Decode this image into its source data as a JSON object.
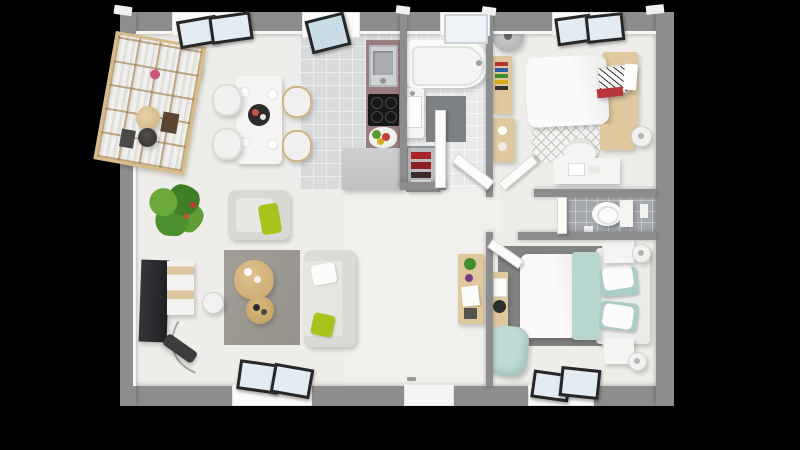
{
  "scene": {
    "title": "Top-down 3D render of a small apartment floor plan",
    "render_style": "photorealistic dollhouse view on black background",
    "background_color": "#000000",
    "rooms_count": 6
  },
  "palette": {
    "wall_gray": "#8d8d8d",
    "floor_ivory": "#f0eeeb",
    "kitchen_tile": "#d8dadc",
    "bath_tile": "#e7e9eb",
    "wc_tile": "#a4a8ac",
    "wood_light": "#e0c89e",
    "wood_mid": "#d2b582",
    "counter_mauve": "#997e81",
    "accent_lime": "#a6c41c",
    "accent_teal": "#b7d6d0",
    "accent_red": "#b8353a",
    "rug_taupe": "#9d9993",
    "rug_dark": "#828282",
    "tv_black": "#26282a",
    "glass_blue": "#e3ecf3",
    "frame_dark": "#262626",
    "plant_green": "#4e8f2e"
  },
  "rooms": [
    {
      "name": "living-dining-room",
      "furniture": [
        "bookshelf",
        "side-stool",
        "vase",
        "wall-lamp",
        "dining-table",
        "dining-chairs-x4",
        "place-settings",
        "serving-tray",
        "potted-plant",
        "tv-panel",
        "tv-stand",
        "arc-floor-lamp",
        "armchair",
        "lime-pillow",
        "taupe-rug",
        "round-coffee-table-large",
        "round-coffee-table-small",
        "sofa",
        "white-pillow",
        "lime-pillow"
      ]
    },
    {
      "name": "kitchen",
      "furniture": [
        "counter-with-sink",
        "cooktop-4-burners",
        "fruit-bowl",
        "base-cabinet"
      ]
    },
    {
      "name": "bathroom",
      "furniture": [
        "bathtub",
        "washbasin-vanity",
        "bath-mat",
        "towel-rack-red",
        "shower-door",
        "swing-door"
      ]
    },
    {
      "name": "bedroom-1",
      "furniture": [
        "floor-lamp",
        "book-ledge",
        "wood-dresser",
        "double-bed-white-duvet",
        "wood-headboard",
        "patterned-pillow",
        "red-accent-pillow",
        "diamond-rug",
        "nightstand",
        "table-lamp",
        "desk",
        "desk-chair",
        "swing-door"
      ]
    },
    {
      "name": "wc",
      "furniture": [
        "toilet",
        "cistern",
        "paper-holder",
        "swing-door"
      ]
    },
    {
      "name": "bedroom-2",
      "furniture": [
        "double-bed-white-duvet",
        "teal-throw",
        "teal-and-white-pillows-x4",
        "bed-frame",
        "dark-rug",
        "nightstand-x2",
        "table-lamp-x2",
        "hall-console-table",
        "wall-desk",
        "teal-pouf",
        "swing-door"
      ]
    }
  ],
  "openings": {
    "top_windows": 4,
    "bottom_windows": 2,
    "entrance_door": 1,
    "interior_doors": 4
  }
}
